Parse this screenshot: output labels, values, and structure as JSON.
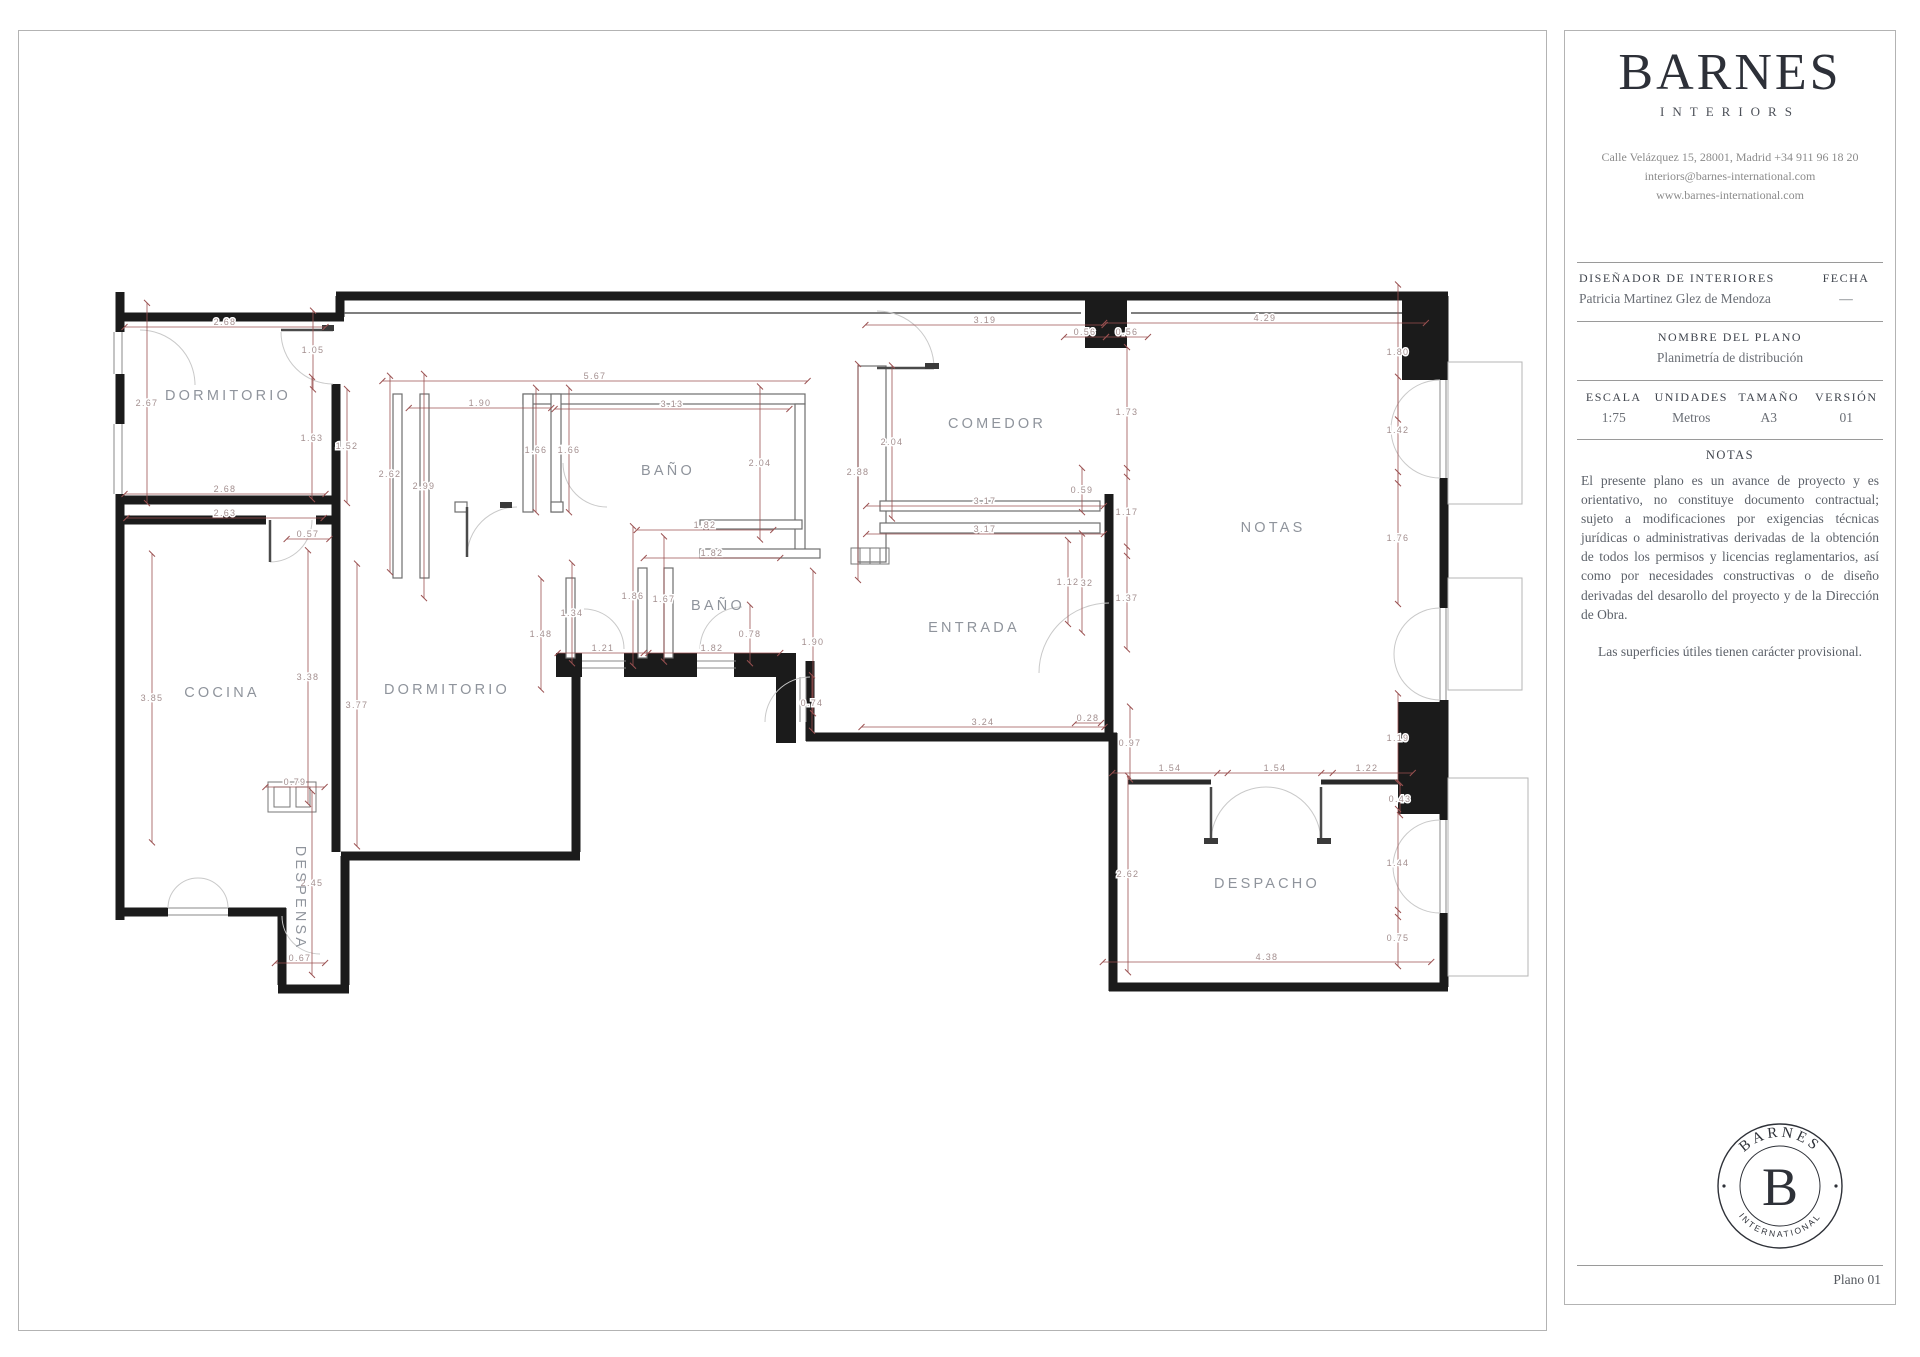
{
  "sidebar": {
    "brand": {
      "name": "BARNES",
      "sub": "INTERIORS"
    },
    "contact": {
      "line1": "Calle Velázquez 15, 28001, Madrid +34 911 96 18 20",
      "line2": "interiors@barnes-international.com",
      "line3": "www.barnes-international.com"
    },
    "designer": {
      "label": "DISEÑADOR DE INTERIORES",
      "value": "Patricia Martinez Glez de Mendoza"
    },
    "fecha": {
      "label": "FECHA",
      "value": "—"
    },
    "plan_name": {
      "label": "NOMBRE DEL PLANO",
      "value": "Planimetría de distribución"
    },
    "specs": [
      {
        "label": "ESCALA",
        "value": "1:75"
      },
      {
        "label": "UNIDADES",
        "value": "Metros"
      },
      {
        "label": "TAMAÑO",
        "value": "A3"
      },
      {
        "label": "VERSIÓN",
        "value": "01"
      }
    ],
    "notes": {
      "label": "NOTAS",
      "paragraph": "El presente plano es un avance de proyecto y es orientativo, no constituye documento contractual; sujeto a modificaciones por exigencias técnicas jurídicas o administrativas derivadas de la obtención de todos los permisos y licencias reglamentarios, así como por necesidades constructivas o de diseño derivadas del desarollo del proyecto y de la Dirección de Obra.",
      "footnote": "Las superficies útiles tienen carácter provisional."
    },
    "stamp": {
      "top": "BARNES",
      "center": "B",
      "bottom": "INTERNATIONAL"
    },
    "page_label": "Plano 01"
  },
  "plan": {
    "colors": {
      "wall": "#1b1b1b",
      "dimension_line": "#9b5151",
      "dimension_text": "#a38f8f",
      "room_label": "#8f949c"
    },
    "rooms": [
      {
        "label": "DORMITORIO",
        "x": 228,
        "y": 400
      },
      {
        "label": "COCINA",
        "x": 222,
        "y": 697
      },
      {
        "label": "DORMITORIO",
        "x": 447,
        "y": 694
      },
      {
        "label": "BAÑO",
        "x": 668,
        "y": 475
      },
      {
        "label": "BAÑO",
        "x": 718,
        "y": 610
      },
      {
        "label": "COMEDOR",
        "x": 997,
        "y": 428
      },
      {
        "label": "ENTRADA",
        "x": 974,
        "y": 632
      },
      {
        "label": "NOTAS",
        "x": 1273,
        "y": 532
      },
      {
        "label": "DESPACHO",
        "x": 1267,
        "y": 888
      },
      {
        "label": "DESPENSA",
        "x": 296,
        "y": 898,
        "rot": 90
      }
    ],
    "dimensions": [
      {
        "v": "2.68",
        "x": 225,
        "y": 322,
        "o": "h"
      },
      {
        "v": "5.67",
        "x": 595,
        "y": 376,
        "o": "h"
      },
      {
        "v": "1.90",
        "x": 480,
        "y": 403,
        "o": "h"
      },
      {
        "v": "3.13",
        "x": 672,
        "y": 404,
        "o": "h"
      },
      {
        "v": "2.68",
        "x": 225,
        "y": 489,
        "o": "h"
      },
      {
        "v": "2.63",
        "x": 225,
        "y": 513,
        "o": "h"
      },
      {
        "v": "0.57",
        "x": 308,
        "y": 534,
        "o": "h"
      },
      {
        "v": "1.82",
        "x": 705,
        "y": 525,
        "o": "h"
      },
      {
        "v": "1.82",
        "x": 712,
        "y": 553,
        "o": "h"
      },
      {
        "v": "1.21",
        "x": 603,
        "y": 648,
        "o": "h"
      },
      {
        "v": "1.82",
        "x": 712,
        "y": 648,
        "o": "h"
      },
      {
        "v": "3.19",
        "x": 985,
        "y": 320,
        "o": "h"
      },
      {
        "v": "0.56",
        "x": 1085,
        "y": 332,
        "o": "h"
      },
      {
        "v": "0.56",
        "x": 1127,
        "y": 332,
        "o": "h"
      },
      {
        "v": "4.29",
        "x": 1265,
        "y": 318,
        "o": "h"
      },
      {
        "v": "3.17",
        "x": 985,
        "y": 501,
        "o": "h"
      },
      {
        "v": "3.17",
        "x": 985,
        "y": 529,
        "o": "h"
      },
      {
        "v": "3.24",
        "x": 983,
        "y": 722,
        "o": "h"
      },
      {
        "v": "0.28",
        "x": 1088,
        "y": 718,
        "o": "h"
      },
      {
        "v": "1.54",
        "x": 1170,
        "y": 768,
        "o": "h"
      },
      {
        "v": "1.54",
        "x": 1275,
        "y": 768,
        "o": "h"
      },
      {
        "v": "1.22",
        "x": 1367,
        "y": 768,
        "o": "h"
      },
      {
        "v": "4.38",
        "x": 1267,
        "y": 957,
        "o": "h"
      },
      {
        "v": "0.67",
        "x": 300,
        "y": 958,
        "o": "h"
      },
      {
        "v": "0.79",
        "x": 295,
        "y": 782,
        "o": "h"
      },
      {
        "v": "2.67",
        "x": 147,
        "y": 403,
        "o": "v"
      },
      {
        "v": "1.05",
        "x": 313,
        "y": 350,
        "o": "v"
      },
      {
        "v": "1.63",
        "x": 312,
        "y": 438,
        "o": "v"
      },
      {
        "v": "1.52",
        "x": 347,
        "y": 446,
        "o": "v"
      },
      {
        "v": "2.62",
        "x": 390,
        "y": 474,
        "o": "v"
      },
      {
        "v": "2.99",
        "x": 424,
        "y": 486,
        "o": "v"
      },
      {
        "v": "1.66",
        "x": 536,
        "y": 450,
        "o": "v"
      },
      {
        "v": "1.66",
        "x": 569,
        "y": 450,
        "o": "v"
      },
      {
        "v": "2.04",
        "x": 760,
        "y": 463,
        "o": "v"
      },
      {
        "v": "1.86",
        "x": 633,
        "y": 596,
        "o": "v"
      },
      {
        "v": "1.67",
        "x": 664,
        "y": 599,
        "o": "v"
      },
      {
        "v": "1.34",
        "x": 572,
        "y": 613,
        "o": "v"
      },
      {
        "v": "1.48",
        "x": 541,
        "y": 634,
        "o": "v"
      },
      {
        "v": "0.78",
        "x": 750,
        "y": 634,
        "o": "v"
      },
      {
        "v": "3.85",
        "x": 152,
        "y": 698,
        "o": "v"
      },
      {
        "v": "3.38",
        "x": 308,
        "y": 677,
        "o": "v"
      },
      {
        "v": "3.77",
        "x": 357,
        "y": 705,
        "o": "v"
      },
      {
        "v": "2.45",
        "x": 312,
        "y": 883,
        "o": "v"
      },
      {
        "v": "2.04",
        "x": 892,
        "y": 442,
        "o": "v"
      },
      {
        "v": "2.88",
        "x": 858,
        "y": 472,
        "o": "v"
      },
      {
        "v": "0.59",
        "x": 1082,
        "y": 490,
        "o": "v"
      },
      {
        "v": "1.73",
        "x": 1127,
        "y": 412,
        "o": "v"
      },
      {
        "v": "1.17",
        "x": 1127,
        "y": 512,
        "o": "v"
      },
      {
        "v": "1.37",
        "x": 1127,
        "y": 598,
        "o": "v"
      },
      {
        "v": "1.32",
        "x": 1082,
        "y": 583,
        "o": "v"
      },
      {
        "v": "1.12",
        "x": 1068,
        "y": 582,
        "o": "v"
      },
      {
        "v": "1.90",
        "x": 813,
        "y": 642,
        "o": "v"
      },
      {
        "v": "0.74",
        "x": 812,
        "y": 703,
        "o": "v"
      },
      {
        "v": "0.97",
        "x": 1130,
        "y": 743,
        "o": "v"
      },
      {
        "v": "1.80",
        "x": 1398,
        "y": 352,
        "o": "v"
      },
      {
        "v": "1.42",
        "x": 1398,
        "y": 430,
        "o": "v"
      },
      {
        "v": "1.76",
        "x": 1398,
        "y": 538,
        "o": "v"
      },
      {
        "v": "1.19",
        "x": 1398,
        "y": 738,
        "o": "v"
      },
      {
        "v": "0.43",
        "x": 1400,
        "y": 799,
        "o": "v"
      },
      {
        "v": "2.62",
        "x": 1128,
        "y": 874,
        "o": "v"
      },
      {
        "v": "1.44",
        "x": 1398,
        "y": 863,
        "o": "v"
      },
      {
        "v": "0.75",
        "x": 1398,
        "y": 938,
        "o": "v"
      }
    ]
  }
}
